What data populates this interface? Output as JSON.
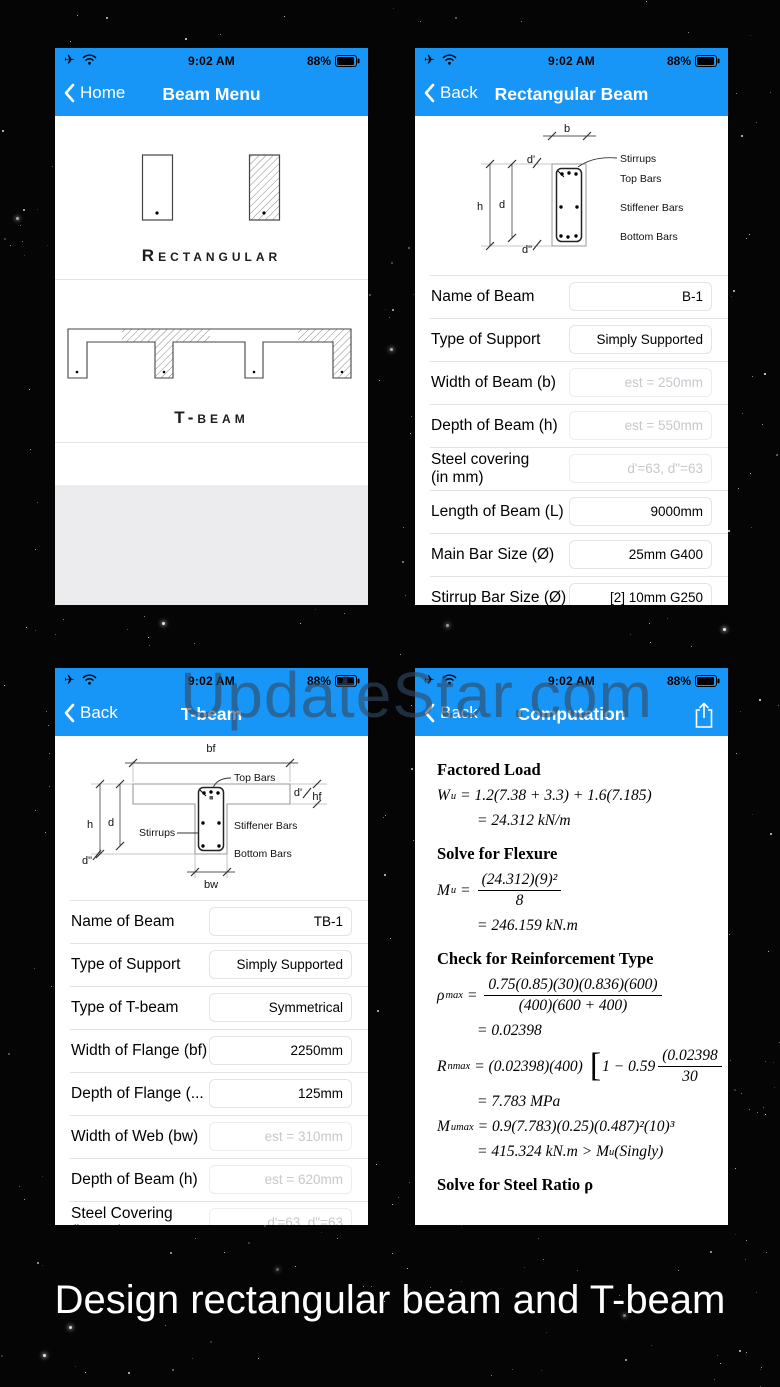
{
  "page": {
    "caption": "Design rectangular beam and T-beam",
    "watermark": "UpdateStar.com"
  },
  "status_bar": {
    "time": "9:02 AM",
    "battery_percent": "88%"
  },
  "beam_menu": {
    "back": "Home",
    "title": "Beam Menu",
    "rect_label": "Rectangular",
    "tbeam_label": "T-beam"
  },
  "rect_screen": {
    "back": "Back",
    "title": "Rectangular Beam",
    "diagram": {
      "b": "b",
      "h": "h",
      "d": "d",
      "d1": "d'",
      "d2": "d\"",
      "stirrups": "Stirrups",
      "top_bars": "Top Bars",
      "stiffener_bars": "Stiffener Bars",
      "bottom_bars": "Bottom Bars"
    },
    "rows": [
      {
        "label": "Name of Beam",
        "value": "B-1"
      },
      {
        "label": "Type of Support",
        "value": "Simply Supported"
      },
      {
        "label": "Width of Beam (b)",
        "value": "est = 250mm",
        "placeholder": true
      },
      {
        "label": "Depth of Beam (h)",
        "value": "est = 550mm",
        "placeholder": true
      },
      {
        "label": "Steel covering",
        "label2": "(in mm)",
        "value": "d'=63, d\"=63",
        "placeholder": true
      },
      {
        "label": "Length of Beam (L)",
        "value": "9000mm"
      },
      {
        "label": "Main Bar Size (Ø)",
        "value": "25mm G400"
      },
      {
        "label": "Stirrup Bar Size (Ø)",
        "value": "[2] 10mm G250"
      }
    ]
  },
  "tbeam_screen": {
    "back": "Back",
    "title": "T-beam",
    "diagram": {
      "bf": "bf",
      "hf": "hf",
      "bw": "bw",
      "h": "h",
      "d": "d",
      "d1": "d'",
      "d2": "d\"",
      "stirrups": "Stirrups",
      "top_bars": "Top Bars",
      "stiffener_bars": "Stiffener Bars",
      "bottom_bars": "Bottom Bars"
    },
    "rows": [
      {
        "label": "Name of Beam",
        "value": "TB-1"
      },
      {
        "label": "Type of Support",
        "value": "Simply Supported"
      },
      {
        "label": "Type of T-beam",
        "value": "Symmetrical"
      },
      {
        "label": "Width of Flange (bf)",
        "value": "2250mm"
      },
      {
        "label": "Depth of Flange (...",
        "value": "125mm"
      },
      {
        "label": "Width of Web (bw)",
        "value": "est = 310mm",
        "placeholder": true
      },
      {
        "label": "Depth of Beam (h)",
        "value": "est = 620mm",
        "placeholder": true
      },
      {
        "label": "Steel Covering",
        "label2": "(in mm)",
        "value": "d'=63, d\"=63",
        "placeholder": true
      }
    ]
  },
  "computation": {
    "back": "Back",
    "title": "Computation",
    "s1_heading": "Factored Load",
    "wu_var": "W",
    "wu_sub": "u",
    "wu_rhs": "= 1.2(7.38 + 3.3) + 1.6(7.185)",
    "wu_result": "= 24.312 kN/m",
    "s2_heading": "Solve for Flexure",
    "mu_var": "M",
    "mu_sub": "u",
    "mu_eq": "=",
    "mu_num": "(24.312)(9)²",
    "mu_den": "8",
    "mu_result": "= 246.159 kN.m",
    "s3_heading": "Check for Reinforcement Type",
    "rho_var": "ρ",
    "rho_sub": "max",
    "rho_eq": "=",
    "rho_num": "0.75(0.85)(30)(0.836)(600)",
    "rho_den": "(400)(600 + 400)",
    "rho_result": "= 0.02398",
    "rn_var": "R",
    "rn_sub": "nmax",
    "rn_pre": "= (0.02398)(400)",
    "rn_bracket": "[",
    "rn_mid": "1 − 0.59",
    "rn_num": "(0.02398",
    "rn_den": "30",
    "rn_result": "= 7.783 MPa",
    "mumax_var": "M",
    "mumax_sub": "umax",
    "mumax_rhs": "= 0.9(7.783)(0.25)(0.487)²(10)³",
    "mumax_result_pre": "= 415.324 kN.m > M",
    "mumax_result_sub": "u",
    "mumax_result_post": " (Singly)",
    "s4_heading": "Solve for Steel Ratio ρ"
  }
}
